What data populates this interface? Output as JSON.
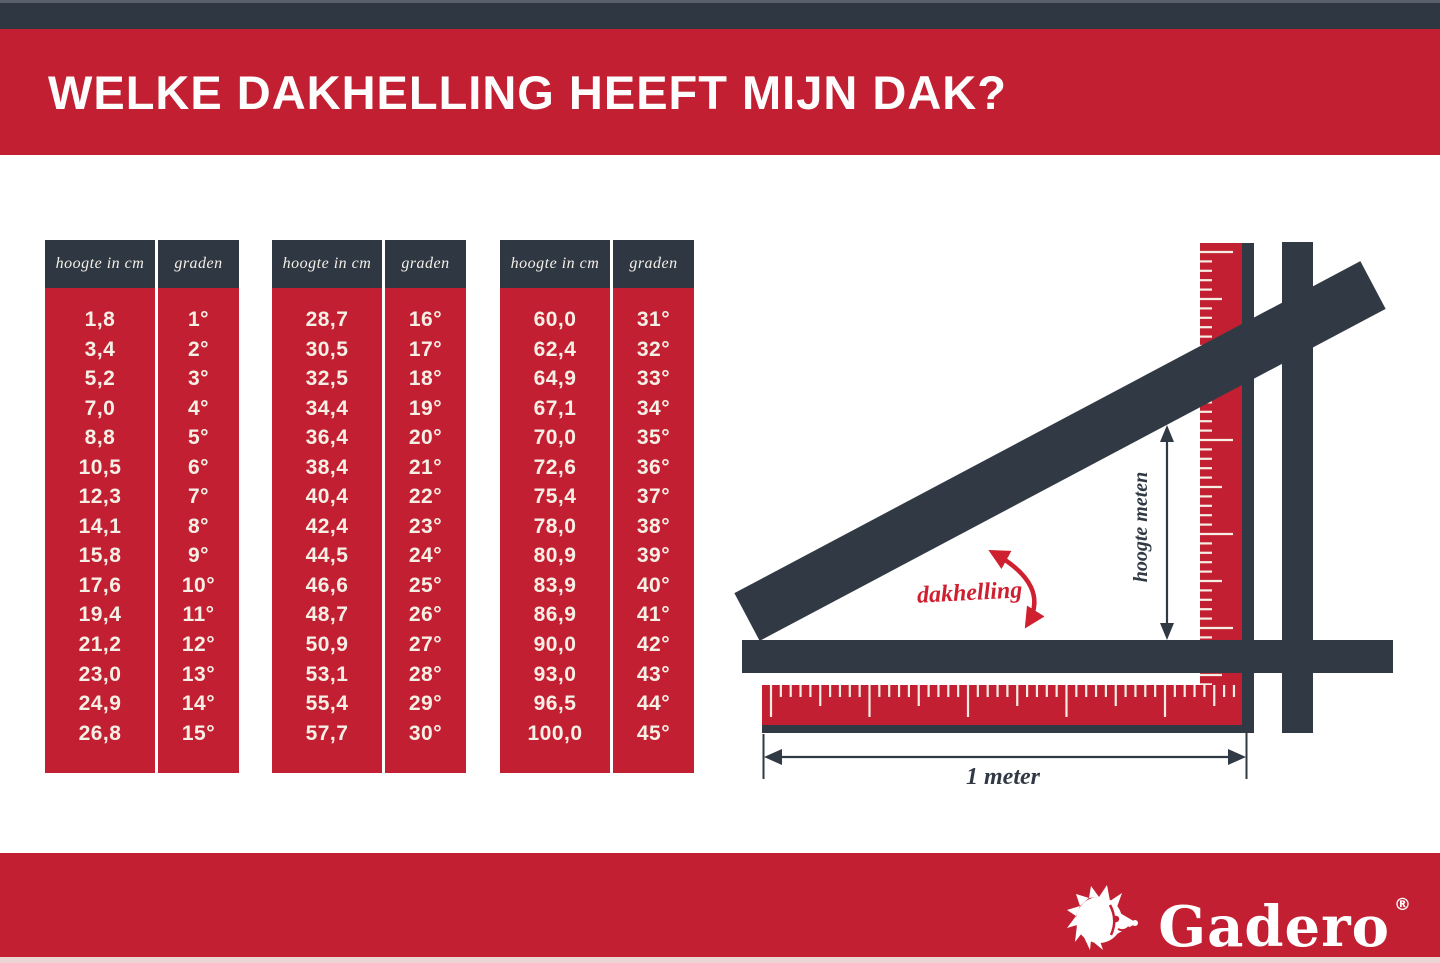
{
  "title": "WELKE DAKHELLING HEEFT MIJN DAK?",
  "colors": {
    "red": "#c22032",
    "dark": "#2e3742",
    "cream_text": "#f6efe5",
    "arrow_red": "#cf2030"
  },
  "tables": [
    {
      "headers": [
        "hoogte in cm",
        "graden"
      ],
      "rows": [
        [
          "1,8",
          "1°"
        ],
        [
          "3,4",
          "2°"
        ],
        [
          "5,2",
          "3°"
        ],
        [
          "7,0",
          "4°"
        ],
        [
          "8,8",
          "5°"
        ],
        [
          "10,5",
          "6°"
        ],
        [
          "12,3",
          "7°"
        ],
        [
          "14,1",
          "8°"
        ],
        [
          "15,8",
          "9°"
        ],
        [
          "17,6",
          "10°"
        ],
        [
          "19,4",
          "11°"
        ],
        [
          "21,2",
          "12°"
        ],
        [
          "23,0",
          "13°"
        ],
        [
          "24,9",
          "14°"
        ],
        [
          "26,8",
          "15°"
        ]
      ]
    },
    {
      "headers": [
        "hoogte in cm",
        "graden"
      ],
      "rows": [
        [
          "28,7",
          "16°"
        ],
        [
          "30,5",
          "17°"
        ],
        [
          "32,5",
          "18°"
        ],
        [
          "34,4",
          "19°"
        ],
        [
          "36,4",
          "20°"
        ],
        [
          "38,4",
          "21°"
        ],
        [
          "40,4",
          "22°"
        ],
        [
          "42,4",
          "23°"
        ],
        [
          "44,5",
          "24°"
        ],
        [
          "46,6",
          "25°"
        ],
        [
          "48,7",
          "26°"
        ],
        [
          "50,9",
          "27°"
        ],
        [
          "53,1",
          "28°"
        ],
        [
          "55,4",
          "29°"
        ],
        [
          "57,7",
          "30°"
        ]
      ]
    },
    {
      "headers": [
        "hoogte in cm",
        "graden"
      ],
      "rows": [
        [
          "60,0",
          "31°"
        ],
        [
          "62,4",
          "32°"
        ],
        [
          "64,9",
          "33°"
        ],
        [
          "67,1",
          "34°"
        ],
        [
          "70,0",
          "35°"
        ],
        [
          "72,6",
          "36°"
        ],
        [
          "75,4",
          "37°"
        ],
        [
          "78,0",
          "38°"
        ],
        [
          "80,9",
          "39°"
        ],
        [
          "83,9",
          "40°"
        ],
        [
          "86,9",
          "41°"
        ],
        [
          "90,0",
          "42°"
        ],
        [
          "93,0",
          "43°"
        ],
        [
          "96,5",
          "44°"
        ],
        [
          "100,0",
          "45°"
        ]
      ]
    }
  ],
  "diagram": {
    "angle_label": "dakhelling",
    "height_label": "hoogte meten",
    "width_label": "1 meter"
  },
  "footer": {
    "brand": "Gadero",
    "registered": "®",
    "logo_icon": "hedgehog-icon"
  }
}
